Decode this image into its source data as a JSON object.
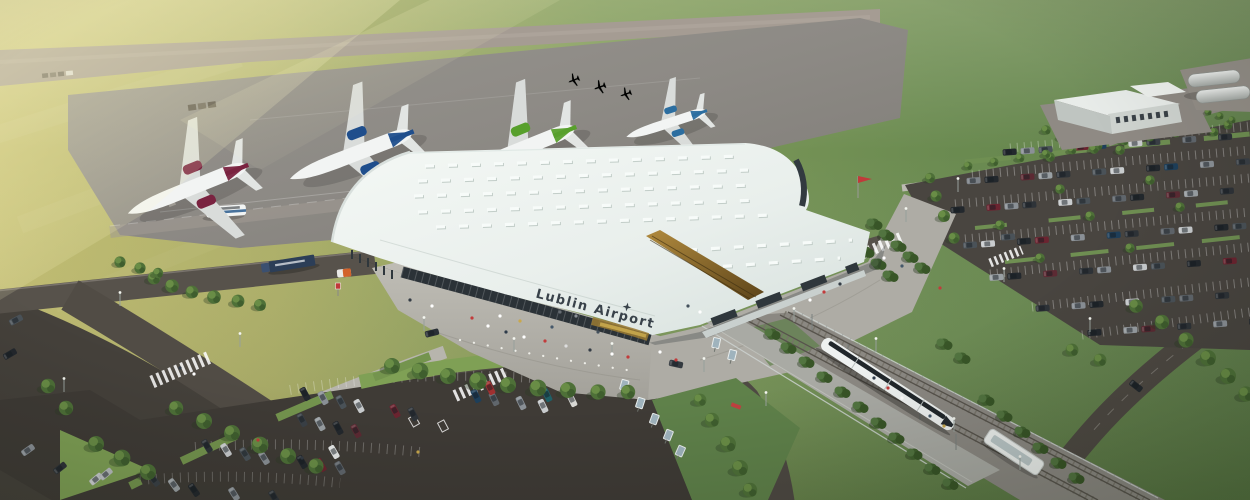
{
  "scene": {
    "description": "Aerial architectural rendering of Lublin Airport: curved white terminal roof with skylights, four airliners and three light aircraft on the apron, runway behind, rail corridor with a white tram at a platform, tree-lined car parks, access roads, service building and fuel tanks.",
    "terminal": {
      "sign_text": "Lublin Airport",
      "logo_icon": "four-point-star"
    },
    "objects": {
      "airliners": 4,
      "airliner_tail_colors": [
        "#7a2340",
        "#1f4e8c",
        "#58a02c",
        "#2c6ea0"
      ],
      "light_aircraft": 3,
      "trams": 1,
      "buses": 1,
      "trucks": 1,
      "buildings": [
        "passenger terminal",
        "service building",
        "fuel tanks"
      ]
    },
    "palette": {
      "grass_sunlit": "#c6c176",
      "grass_green": "#6d8c51",
      "runway": "#a59c93",
      "apron": "#8d8a85",
      "road": "#4e4943",
      "parking_asphalt": "#413d38",
      "pavement": "#b5b3ab",
      "roof_white": "#eef3f0",
      "glass_dark": "#2b3237",
      "gold_accent": "#a5803a",
      "tree_green": "#4e7038",
      "tram_white": "#eef1f0"
    }
  }
}
